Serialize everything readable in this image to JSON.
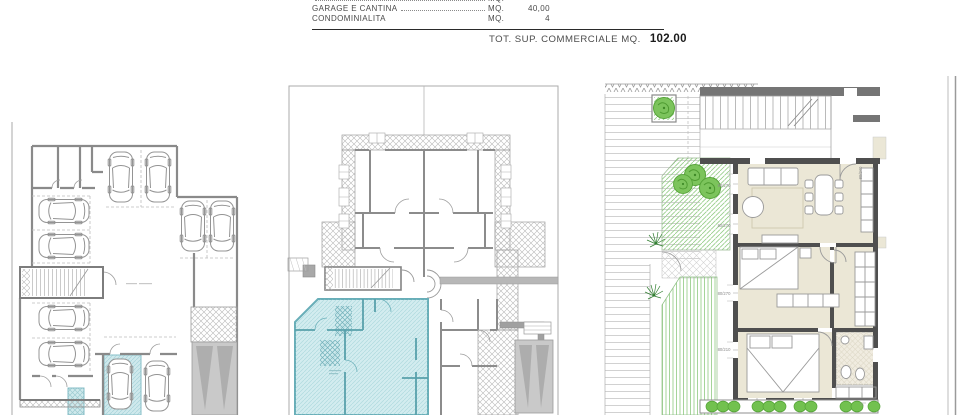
{
  "header": {
    "rows": [
      {
        "label": "",
        "unit": "MQ.",
        "value": ""
      },
      {
        "label": "GARAGE E CANTINA",
        "unit": "MQ.",
        "value": "40,00"
      },
      {
        "label": "CONDOMINIALITA",
        "unit": "MQ.",
        "value": "4"
      }
    ],
    "total_label": "TOT. SUP. COMMERCIALE MQ.",
    "total_value": "102.00"
  },
  "dims": [
    "80/270",
    "80/270",
    "80/270",
    "80/210",
    "80/240"
  ],
  "colors": {
    "highlight_cyan": "#cfe9ec",
    "teal_outline": "#68aeb8",
    "garden_green": "#7cc45c",
    "floor_beige": "#ebe7d6",
    "wall_dark": "#4f4f4f",
    "wall_gray": "#8a8a8a"
  }
}
